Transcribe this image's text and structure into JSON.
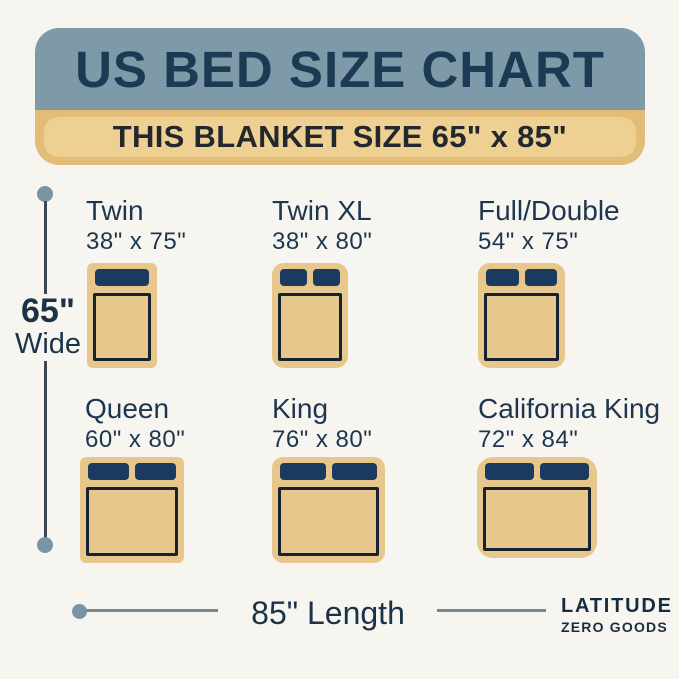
{
  "header": {
    "title": "US BED SIZE CHART",
    "subtitle": "THIS BLANKET SIZE 65\" x 85\""
  },
  "beds": [
    {
      "name": "Twin",
      "size": "38\" x 75\"",
      "pillows": 1
    },
    {
      "name": "Twin XL",
      "size": "38\" x 80\"",
      "pillows": 2
    },
    {
      "name": "Full/Double",
      "size": "54\" x 75\"",
      "pillows": 2
    },
    {
      "name": "Queen",
      "size": "60\" x 80\"",
      "pillows": 2
    },
    {
      "name": "King",
      "size": "76\" x 80\"",
      "pillows": 2
    },
    {
      "name": "California King",
      "size": "72\" x 84\"",
      "pillows": 2
    }
  ],
  "dimensions": {
    "width_value": "65\"",
    "width_word": "Wide",
    "length_label": "85\" Length"
  },
  "brand": {
    "line1": "LATITUDE",
    "line2": "ZERO GOODS"
  },
  "colors": {
    "background": "#f7f5f0",
    "header_bg": "#7e99a8",
    "header_text": "#1d3a55",
    "banner_outer": "#e3bc78",
    "banner_inner": "#efd093",
    "banner_text": "#23282e",
    "blanket": "#e8c78c",
    "pillow": "#1a3a60",
    "mattress_outline": "#162230",
    "label_text": "#1e3550",
    "dimension_dot": "#7b94a3",
    "dimension_line_vertical": "#3c4852",
    "dimension_line_horizontal": "#78868f",
    "brand_text": "#182c41"
  }
}
